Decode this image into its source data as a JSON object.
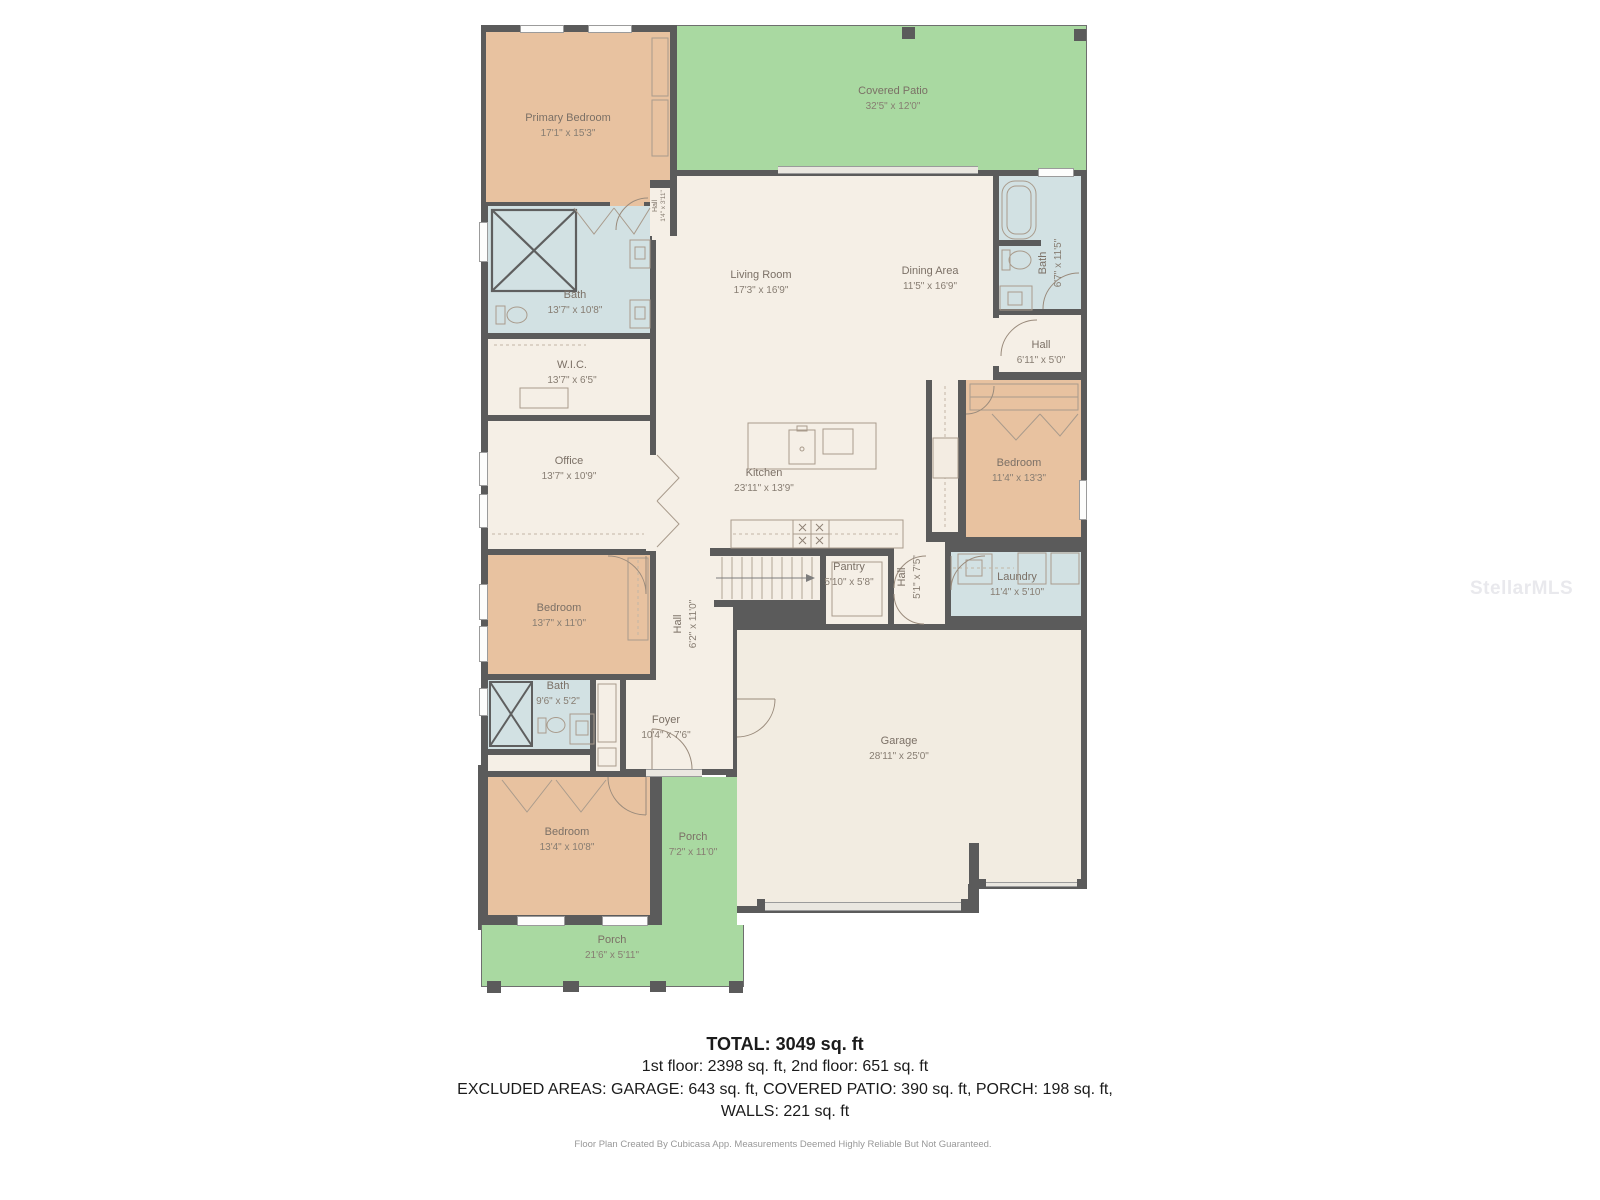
{
  "watermark": "StellarMLS",
  "summary": {
    "total": "TOTAL: 3049 sq. ft",
    "floors": "1st floor: 2398 sq. ft, 2nd floor: 651 sq. ft",
    "excluded": "EXCLUDED AREAS: GARAGE: 643 sq. ft, COVERED PATIO: 390 sq. ft, PORCH: 198 sq. ft,",
    "walls": "WALLS: 221 sq. ft",
    "credit": "Floor Plan Created By Cubicasa App. Measurements Deemed Highly Reliable But Not Guaranteed."
  },
  "colors": {
    "bedroom": "#e8c2a0",
    "bath": "#d2e1e3",
    "livingArea": "#f5efe6",
    "outdoor": "#a9d9a1",
    "wall": "#5b5b5b"
  },
  "rooms": [
    {
      "name": "Primary Bedroom",
      "dims": "17'1\" x 15'3\""
    },
    {
      "name": "Covered Patio",
      "dims": "32'5\" x 12'0\""
    },
    {
      "name": "Hall",
      "dims": "1'4\" x 3'11\""
    },
    {
      "name": "Living Room",
      "dims": "17'3\" x 16'9\""
    },
    {
      "name": "Dining Area",
      "dims": "11'5\" x 16'9\""
    },
    {
      "name": "Bath",
      "dims": "6'7\" x 11'5\""
    },
    {
      "name": "Bath",
      "dims": "13'7\" x 10'8\""
    },
    {
      "name": "Hall",
      "dims": "6'11\" x 5'0\""
    },
    {
      "name": "W.I.C.",
      "dims": "13'7\" x 6'5\""
    },
    {
      "name": "Office",
      "dims": "13'7\" x 10'9\""
    },
    {
      "name": "Bedroom",
      "dims": "11'4\" x 13'3\""
    },
    {
      "name": "Kitchen",
      "dims": "23'11\" x 13'9\""
    },
    {
      "name": "Bedroom",
      "dims": "13'7\" x 11'0\""
    },
    {
      "name": "Pantry",
      "dims": "5'10\" x 5'8\""
    },
    {
      "name": "Hall",
      "dims": "5'1\" x 7'5\""
    },
    {
      "name": "Laundry",
      "dims": "11'4\" x 5'10\""
    },
    {
      "name": "Hall",
      "dims": "6'2\" x 11'0\""
    },
    {
      "name": "Bath",
      "dims": "9'6\" x 5'2\""
    },
    {
      "name": "Foyer",
      "dims": "10'4\" x 7'6\""
    },
    {
      "name": "Garage",
      "dims": "28'11\" x 25'0\""
    },
    {
      "name": "Bedroom",
      "dims": "13'4\" x 10'8\""
    },
    {
      "name": "Porch",
      "dims": "7'2\" x 11'0\""
    },
    {
      "name": "Porch",
      "dims": "21'6\" x 5'11\""
    }
  ]
}
